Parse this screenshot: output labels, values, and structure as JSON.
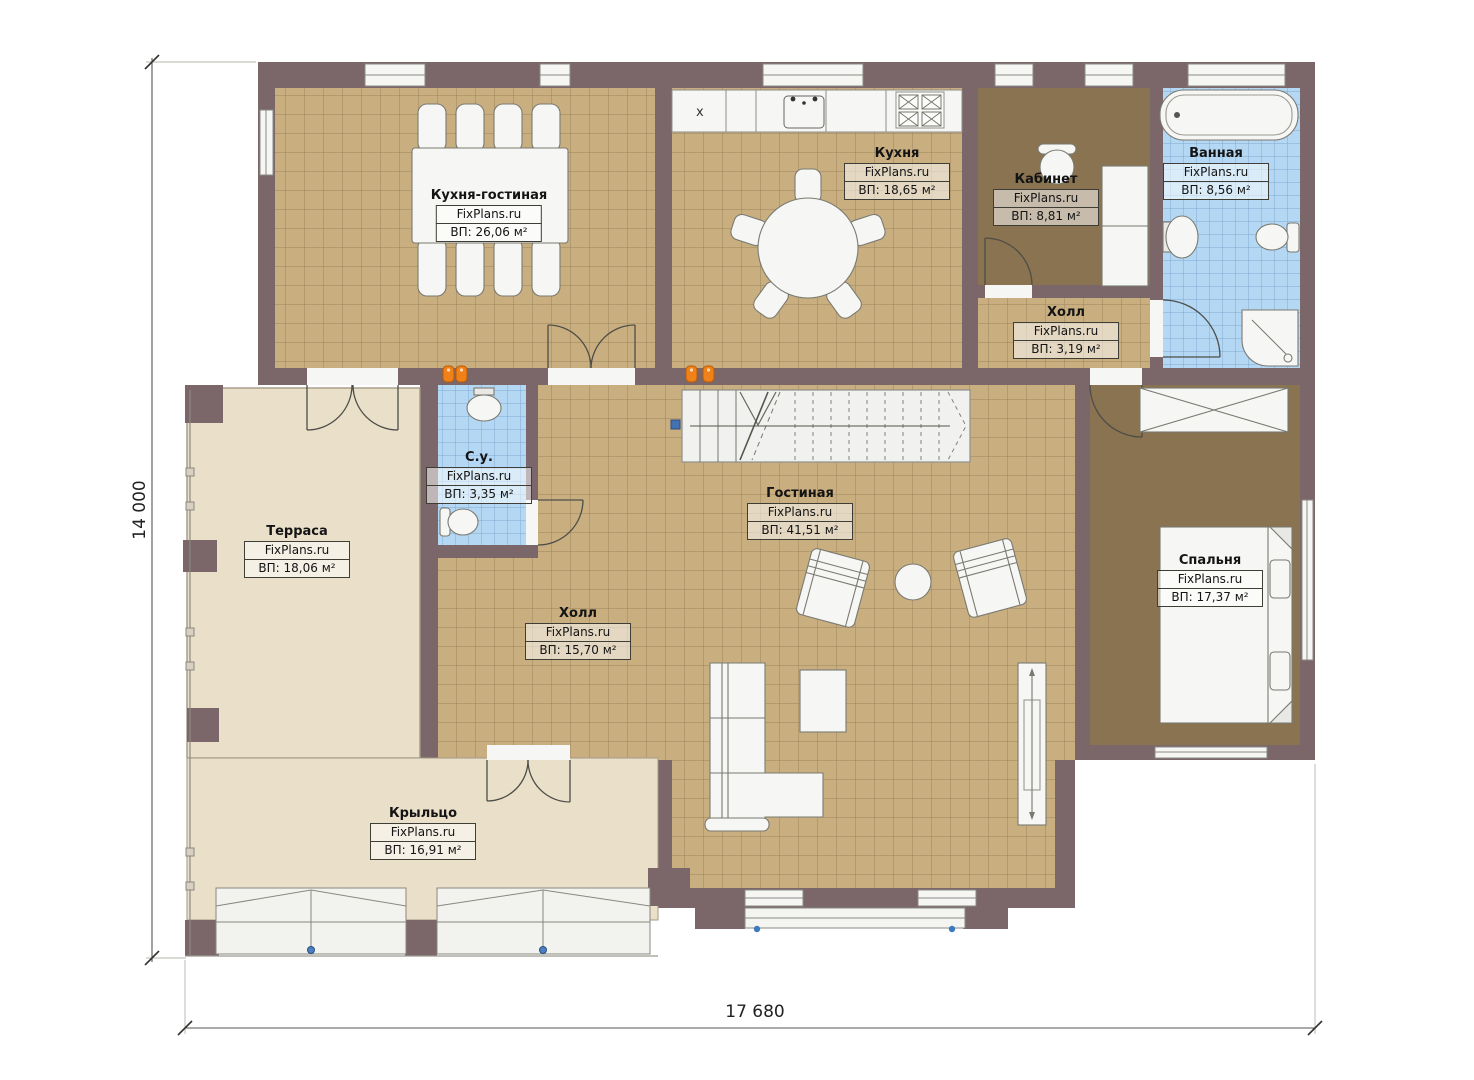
{
  "brand": "FixPlans.ru",
  "dimensions": {
    "width_label": "17 680",
    "height_label": "14 000"
  },
  "marks": {
    "counter_x": "x"
  },
  "rooms": [
    {
      "name": "Кухня-гостиная",
      "brand": "FixPlans.ru",
      "area": "ВП: 26,06 м²"
    },
    {
      "name": "Кухня",
      "brand": "FixPlans.ru",
      "area": "ВП: 18,65 м²"
    },
    {
      "name": "Кабинет",
      "brand": "FixPlans.ru",
      "area": "ВП: 8,81 м²"
    },
    {
      "name": "Ванная",
      "brand": "FixPlans.ru",
      "area": "ВП: 8,56 м²"
    },
    {
      "name": "Холл",
      "brand": "FixPlans.ru",
      "area": "ВП: 3,19 м²"
    },
    {
      "name": "С.у.",
      "brand": "FixPlans.ru",
      "area": "ВП: 3,35 м²"
    },
    {
      "name": "Гостиная",
      "brand": "FixPlans.ru",
      "area": "ВП: 41,51 м²"
    },
    {
      "name": "Терраса",
      "brand": "FixPlans.ru",
      "area": "ВП: 18,06 м²"
    },
    {
      "name": "Холл",
      "brand": "FixPlans.ru",
      "area": "ВП: 15,70 м²"
    },
    {
      "name": "Спальня",
      "brand": "FixPlans.ru",
      "area": "ВП: 17,37 м²"
    },
    {
      "name": "Крыльцо",
      "brand": "FixPlans.ru",
      "area": "ВП: 16,91 м²"
    }
  ],
  "colors": {
    "wall": "#7b6669",
    "tile_floor": "#c9ae80",
    "carpet_floor": "#8a7350",
    "bath_tile": "#b4d7f3",
    "terrace_floor": "#eadfc9",
    "fixture_white": "#f6f6f4",
    "radiator_orange": "#f08018"
  }
}
